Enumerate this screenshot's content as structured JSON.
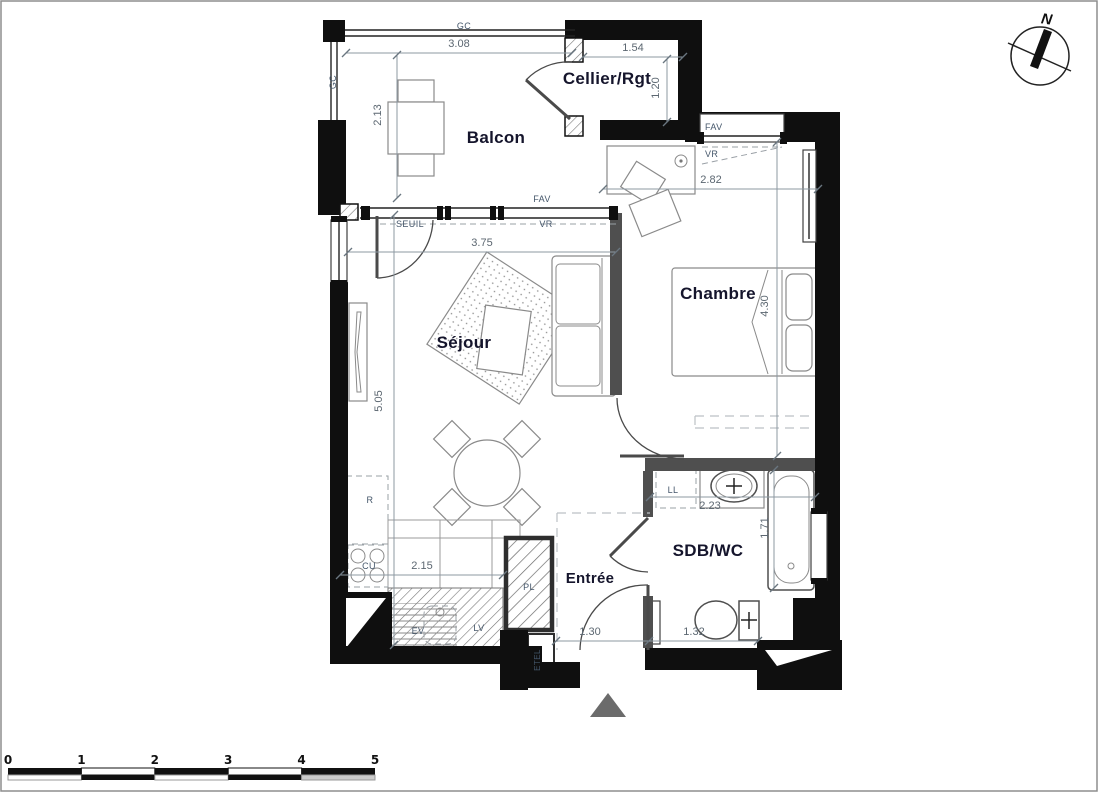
{
  "rooms": {
    "balcon": {
      "label": "Balcon"
    },
    "cellier": {
      "label": "Cellier/Rgt"
    },
    "chambre": {
      "label": "Chambre"
    },
    "sejour": {
      "label": "Séjour"
    },
    "sdb": {
      "label": "SDB/WC"
    },
    "entree": {
      "label": "Entrée"
    }
  },
  "dimensions": {
    "balcon_width": "3.08",
    "cellier_width": "1.54",
    "balcon_depth": "2.13",
    "cellier_depth": "1.20",
    "chambre_width": "2.82",
    "chambre_depth": "4.30",
    "sejour_width": "3.75",
    "sejour_depth": "5.05",
    "kitchen_width": "2.15",
    "sdb_width": "2.23",
    "bath_length": "1.71",
    "entree_width": "1.30",
    "sdb_bottom_width": "1.32"
  },
  "tags": {
    "gc_top": "GC",
    "gc_left": "GC",
    "fav_balcon": "FAV",
    "seuil": "SEUIL",
    "vr_sejour": "VR",
    "fav_chambre": "FAV",
    "vr_chambre": "VR",
    "r": "R",
    "cu": "CU",
    "ev": "EV",
    "lv": "LV",
    "pl": "PL",
    "etel": "ETEL",
    "ll": "LL"
  },
  "compass": {
    "north_label": "N"
  },
  "scale_bar": {
    "ticks": [
      "0",
      "1",
      "2",
      "3",
      "4",
      "5"
    ]
  },
  "colors": {
    "exterior_wall": "#0f0f0f",
    "partition_wall": "#4f4f4f",
    "room_label": "#15152c",
    "dimension_text": "#5c6771",
    "tag_text": "#44566a",
    "entrance_marker": "#6b6b6b"
  }
}
